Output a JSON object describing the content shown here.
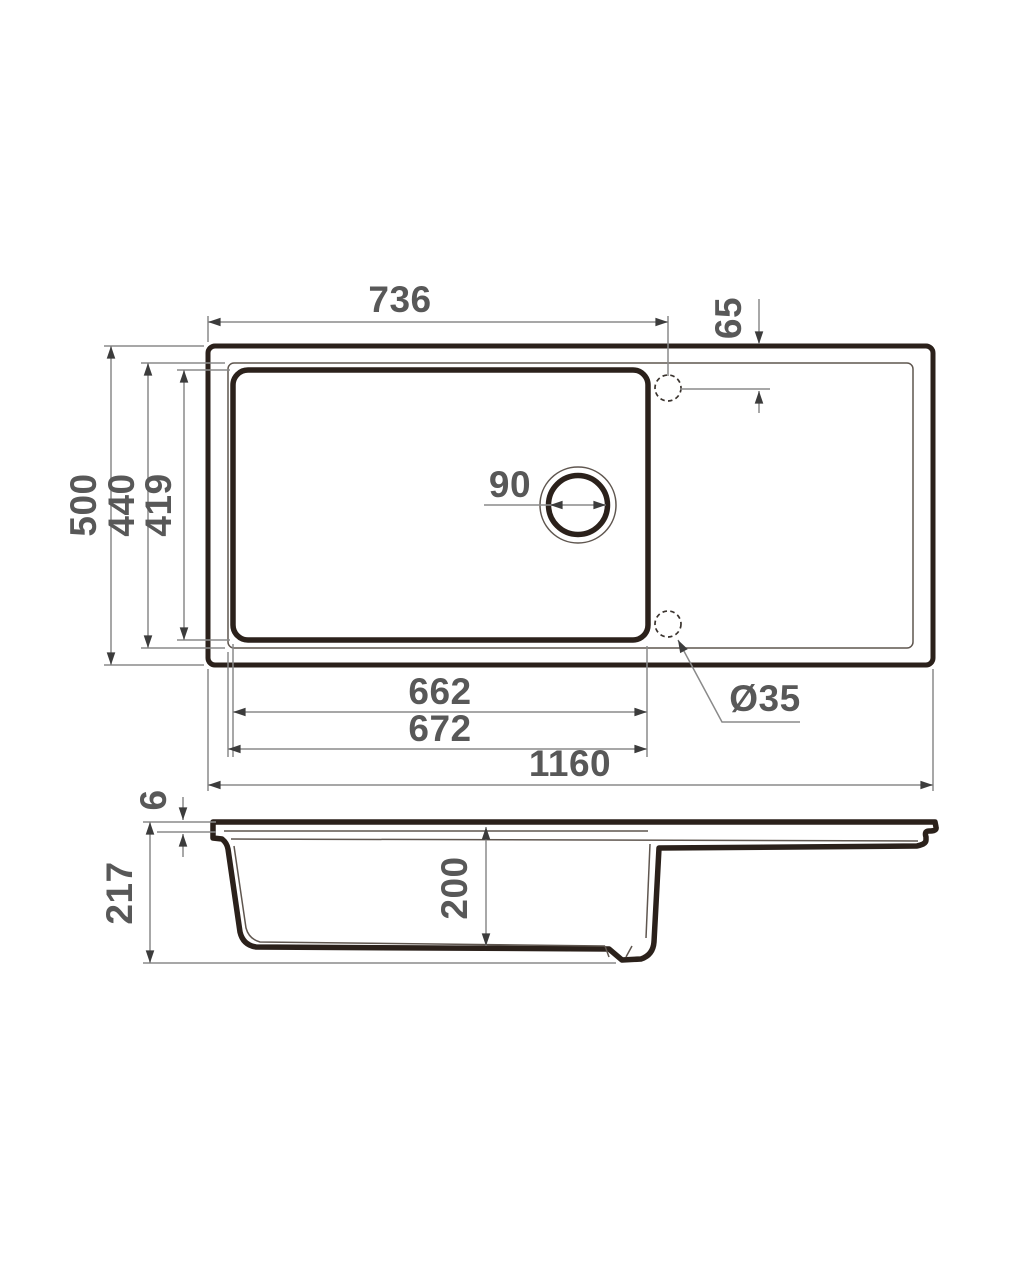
{
  "drawing": {
    "kind": "kitchen-sink-technical-drawing",
    "background": "#ffffff",
    "colors": {
      "outline": "#2b211b",
      "thin_line": "#5f564f",
      "dimension_line": "#8a8a8a",
      "arrow": "#3c3c3c",
      "label_text": "#585858"
    }
  },
  "dims": {
    "hole_offset_x": "736",
    "hole_offset_y": "65",
    "overall_depth": "500",
    "rim_depth": "440",
    "bowl_depth": "419",
    "drain_diameter": "90",
    "bowl_width": "662",
    "rim_width": "672",
    "overall_width": "1160",
    "tap_hole_diameter": "Ø35",
    "edge_thickness": "6",
    "overall_height": "217",
    "bowl_height": "200"
  }
}
